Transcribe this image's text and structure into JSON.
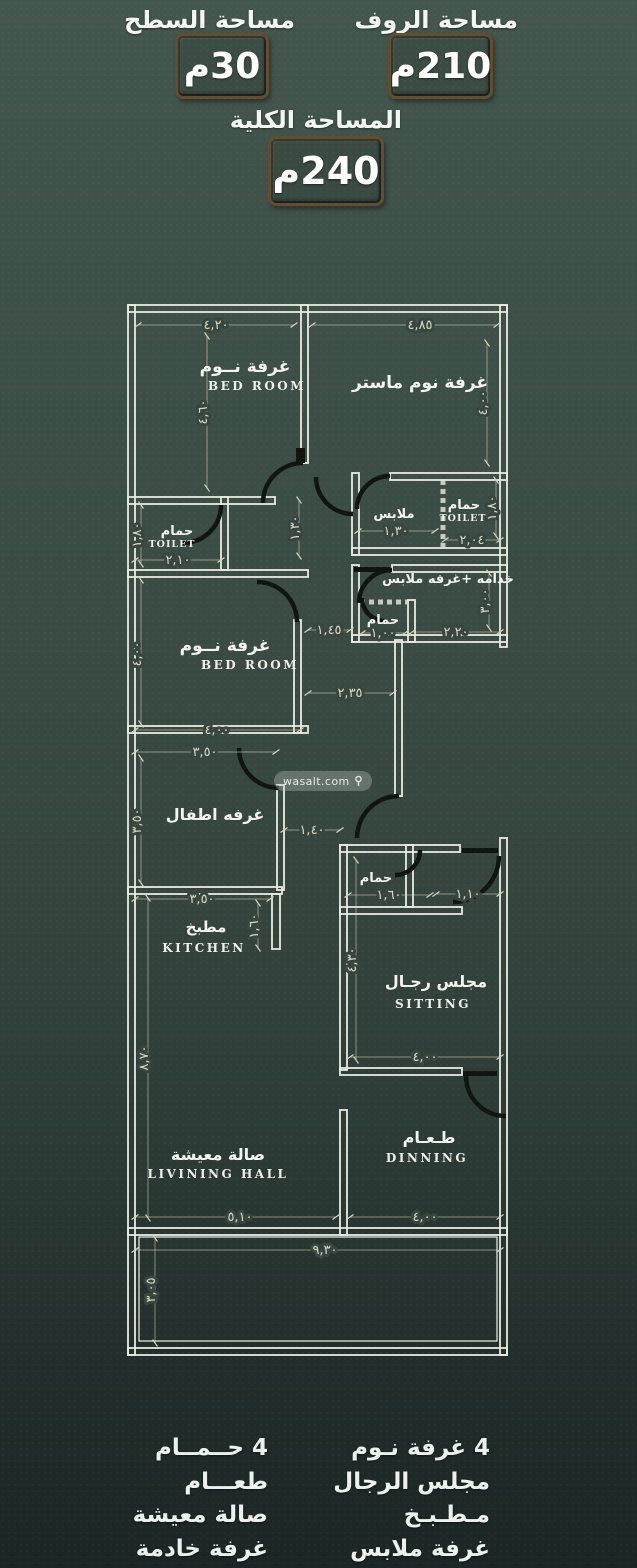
{
  "header": {
    "surface_label": "مساحة السطح",
    "surface_value": "30م",
    "roof_label": "مساحة الروف",
    "roof_value": "210م",
    "total_label": "المساحة الكلية",
    "total_value": "240م"
  },
  "watermark": {
    "text": "wasalt.com",
    "icon": "location-pin"
  },
  "plan": {
    "rooms": {
      "bedroom1": {
        "ar": "غرفة نــوم",
        "en": "BED ROOM"
      },
      "master": {
        "ar": "غرفة نوم ماستر"
      },
      "toilet_left": {
        "ar": "حمام",
        "en": "TOILET"
      },
      "closet": {
        "ar": "ملابس"
      },
      "toilet_master": {
        "ar": "حمام",
        "en": "TOILET"
      },
      "maid": {
        "ar": "خدامه +غرفه ملابس"
      },
      "maid_bath": {
        "ar": "حمام"
      },
      "bedroom2": {
        "ar": "غرفة نــوم",
        "en": "BED ROOM"
      },
      "kids": {
        "ar": "غرفه اطفال"
      },
      "kitchen": {
        "ar": "مطبخ",
        "en": "KITCHEN"
      },
      "sitting_bath": {
        "ar": "حمام"
      },
      "sitting": {
        "ar": "مجلس رجـال",
        "en": "SITTING"
      },
      "living": {
        "ar": "صالة معيشة",
        "en": "LIVINING HALL"
      },
      "dining": {
        "ar": "طـعـام",
        "en": "DINNING"
      }
    },
    "dims": {
      "bedroom1_top": "٤,٢٠",
      "master_top": "٤,٨٥",
      "bedroom1_side": "٤,٦٠",
      "master_side": "٤,٠٠",
      "toilet_left_side": "١,٨٠",
      "toilet_left_w": "٢,١٠",
      "corridor_side": "١,٣٠",
      "closet_w": "١,٣٠",
      "toilet_master_w": "٢,٠٤",
      "toilet_master_side": "١,٨٠",
      "hall_w": "١,٤٥",
      "maid_bath_w": "١,٠٠",
      "maid_w": "٢,٢٠",
      "maid_side": "٣,٠٠",
      "hall_w2": "٢,٣٥",
      "bedroom2_side": "٤,٠٠",
      "bedroom2_w": "٤,٠٠",
      "kids_w": "٣,٥٠",
      "kids_side": "٣,٥٠",
      "corridor_w": "١,٤٠",
      "kitchen_w": "٣,٥٠",
      "kitchen_side": "١,٦٠",
      "sitting_bath_w1": "١,٦٠",
      "sitting_bath_w2": "١,١٠",
      "sitting_side": "٤,٣٠",
      "sitting_w": "٤,٠٠",
      "living_side": "٨,٧٠",
      "living_w": "٥,١٠",
      "dining_w": "٤,٠٠",
      "plot_w": "٩,٣٠",
      "yard_side": "٣,٠٥"
    }
  },
  "legend": {
    "right": [
      "4 غرفة نـوم",
      "مجلس الرجال",
      "مـطـبـخ",
      "غرفة ملابس"
    ],
    "left": [
      "4 حــمــام",
      "طعـــام",
      "صالة معيشة",
      "غرفة خادمة"
    ]
  },
  "colors": {
    "background_top": "#44574e",
    "background_bottom": "#1c2624",
    "wall": "#e9eae0",
    "dimension_text": "#ddd8c0",
    "box_border": "#634c2f",
    "text": "#f4f6f1"
  }
}
